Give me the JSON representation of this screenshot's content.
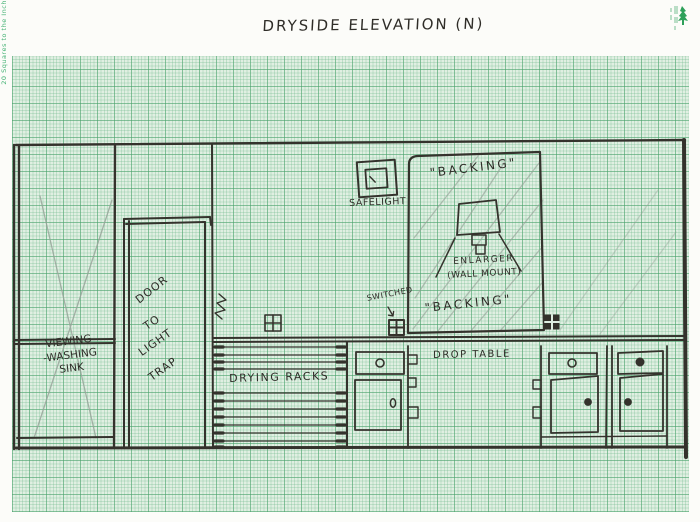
{
  "page": {
    "title": "DRYSIDE ELEVATION (N)",
    "margin_note": "20 Squares to the Inch"
  },
  "labels": {
    "sink": "VIEWING\n-WASHING\nSINK",
    "door_words": [
      "DOOR",
      "TO",
      "LIGHT",
      "TRAP"
    ],
    "drying_racks": "DRYING RACKS",
    "drop_table": "DROP TABLE",
    "safelight": "SAFELIGHT",
    "backing_top": "\"BACKING\"",
    "backing_bottom": "\"BACKING\"",
    "enlarger": "ENLARGER",
    "enlarger_mount": "(WALL MOUNT)",
    "switched": "SWITCHED"
  },
  "colors": {
    "paper_green": "#e0efe2",
    "grid_line_green": "#46a069",
    "ink": "#33312c",
    "pencil": "#98a59a",
    "brand_green": "#2ea05a"
  }
}
